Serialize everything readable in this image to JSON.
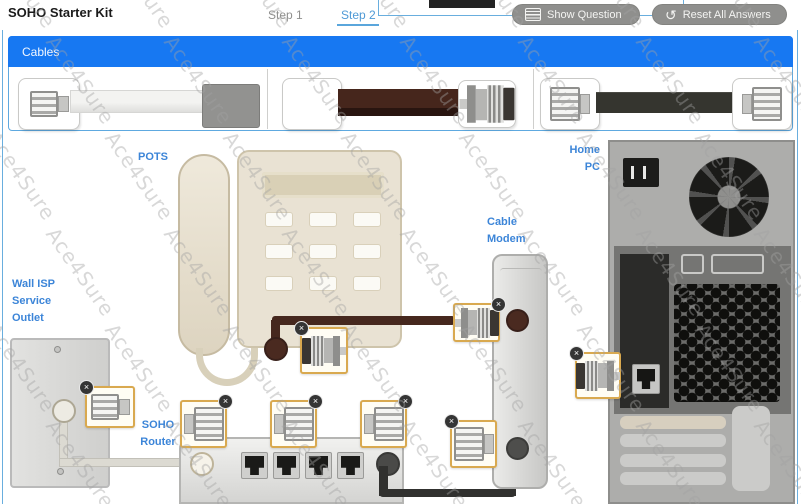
{
  "window": {
    "title": "SOHO Starter Kit"
  },
  "tabs": {
    "step1": "Step 1",
    "step2": "Step 2",
    "active_tab": "Step 2"
  },
  "toolbar": {
    "show_question": "Show Question",
    "reset_all": "Reset All Answers"
  },
  "cables_panel": {
    "title": "Cables",
    "items": [
      {
        "type": "telephone-cable",
        "left_end": "rj11-connector",
        "right_end": "gray-unterminated-plug"
      },
      {
        "type": "coaxial-cable",
        "left_end": "empty-slot",
        "right_end": "f-connector"
      },
      {
        "type": "ethernet-cable",
        "left_end": "rj45-connector",
        "right_end": "rj45-connector"
      }
    ]
  },
  "diagram": {
    "labels": {
      "pots": "POTS",
      "wall": [
        "Wall ISP",
        "Service",
        "Outlet"
      ],
      "modem": [
        "Cable",
        "Modem"
      ],
      "pc": [
        "Home",
        "PC"
      ],
      "router": [
        "SOHO",
        "Router"
      ],
      "phone_service": [
        "Phone",
        "Service"
      ],
      "lan": "LAN 1-4",
      "wan": "WAN"
    },
    "placed_connectors": [
      {
        "location": "phone-coax-end",
        "icon": "f-connector-icon",
        "removable": true
      },
      {
        "location": "modem-coax-port",
        "icon": "f-connector-icon",
        "removable": true
      },
      {
        "location": "modem-ethernet-port",
        "icon": "rj45-connector-icon",
        "removable": true
      },
      {
        "location": "wall-outlet-jack",
        "icon": "rj45-connector-icon",
        "removable": true
      },
      {
        "location": "router-phone-service",
        "icon": "rj45-connector-icon",
        "removable": true
      },
      {
        "location": "router-lan",
        "icon": "rj45-connector-icon",
        "removable": true
      },
      {
        "location": "router-wan",
        "icon": "rj45-connector-icon",
        "removable": true
      },
      {
        "location": "pc-ethernet-jack",
        "icon": "f-connector-icon",
        "removable": true
      }
    ]
  },
  "ui": {
    "remove_glyph": "×",
    "reset_glyph": "↺"
  },
  "watermark": {
    "text": "Ace4Sure"
  },
  "colors": {
    "accent_blue": "#1778f2",
    "label_blue": "#3c85d8",
    "tab_blue": "#4f9ad6",
    "slot_border_orange": "#d9a94f",
    "coax_brown": "#46281e",
    "ethernet_black": "#35352f",
    "button_gray": "#8f8f8d"
  }
}
